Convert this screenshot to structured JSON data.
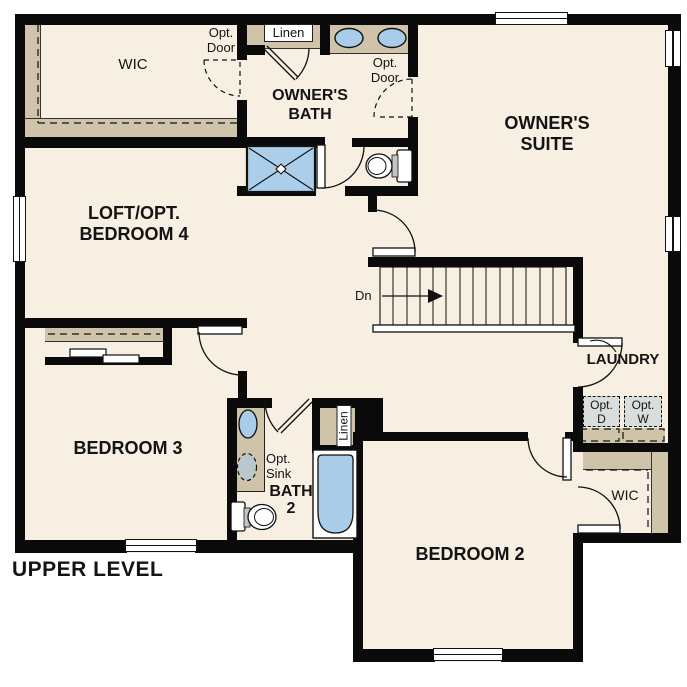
{
  "title": "UPPER LEVEL",
  "colors": {
    "wall": "#0a0a0a",
    "floor": "#f6efe2",
    "cabinet_tan": "#cfc3a9",
    "fixture_blue": "#a9cce9",
    "appliance_gray": "#d9dddc",
    "background": "#ffffff"
  },
  "labels": {
    "wic_owner": "WIC",
    "opt_door_left": {
      "line1": "Opt.",
      "line2": "Door"
    },
    "linen_owner": "Linen",
    "owners_bath": {
      "line1": "OWNER'S",
      "line2": "BATH"
    },
    "opt_door_right": {
      "line1": "Opt.",
      "line2": "Door"
    },
    "owners_suite": {
      "line1": "OWNER'S",
      "line2": "SUITE"
    },
    "loft": {
      "line1": "LOFT/OPT.",
      "line2": "BEDROOM 4"
    },
    "stairs_dn": "Dn",
    "laundry": "LAUNDRY",
    "opt_dryer": {
      "line1": "Opt.",
      "line2": "D"
    },
    "opt_washer": {
      "line1": "Opt.",
      "line2": "W"
    },
    "wic_bedroom2": "WIC",
    "bedroom3": "BEDROOM 3",
    "opt_sink": {
      "line1": "Opt.",
      "line2": "Sink"
    },
    "bath2": {
      "line1": "BATH",
      "line2": "2"
    },
    "linen_bath2": "Linen",
    "bedroom2": "BEDROOM 2"
  }
}
